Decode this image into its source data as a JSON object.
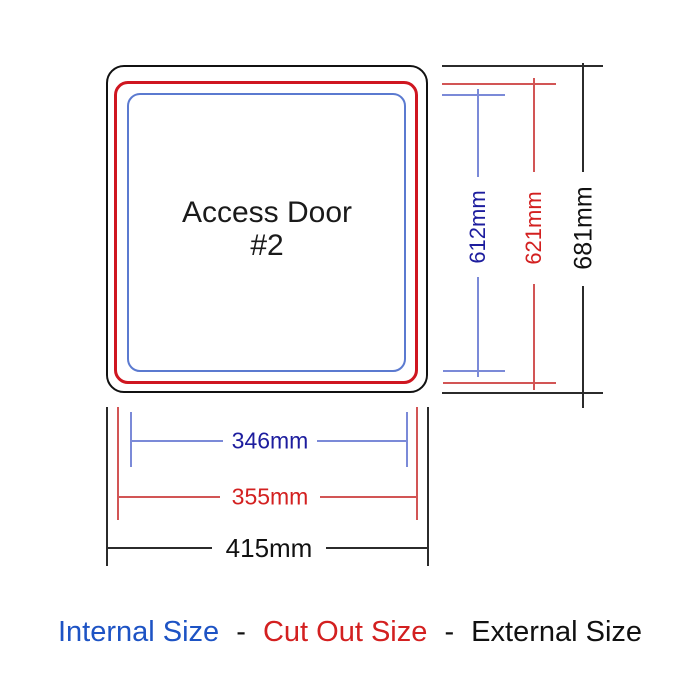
{
  "diagram": {
    "door": {
      "label_line1": "Access Door",
      "label_line2": "#2"
    },
    "dimensions": {
      "internal_width": "346mm",
      "cutout_width": "355mm",
      "external_width": "415mm",
      "internal_height": "612mm",
      "cutout_height": "621mm",
      "external_height": "681mm"
    },
    "legend": {
      "internal": "Internal Size",
      "separator": "-",
      "cutout": "Cut Out Size",
      "external": "External Size"
    },
    "colors": {
      "background": "#ffffff",
      "internal_text": "#1d1d9e",
      "internal_line": "#7b8ad8",
      "internal_box": "#5b7ad0",
      "cutout_text": "#d32020",
      "cutout_line": "#d25555",
      "cutout_box": "#cf1620",
      "external_text": "#111111",
      "external_line": "#2b2b2b",
      "legend_internal": "#1d53c4"
    }
  }
}
